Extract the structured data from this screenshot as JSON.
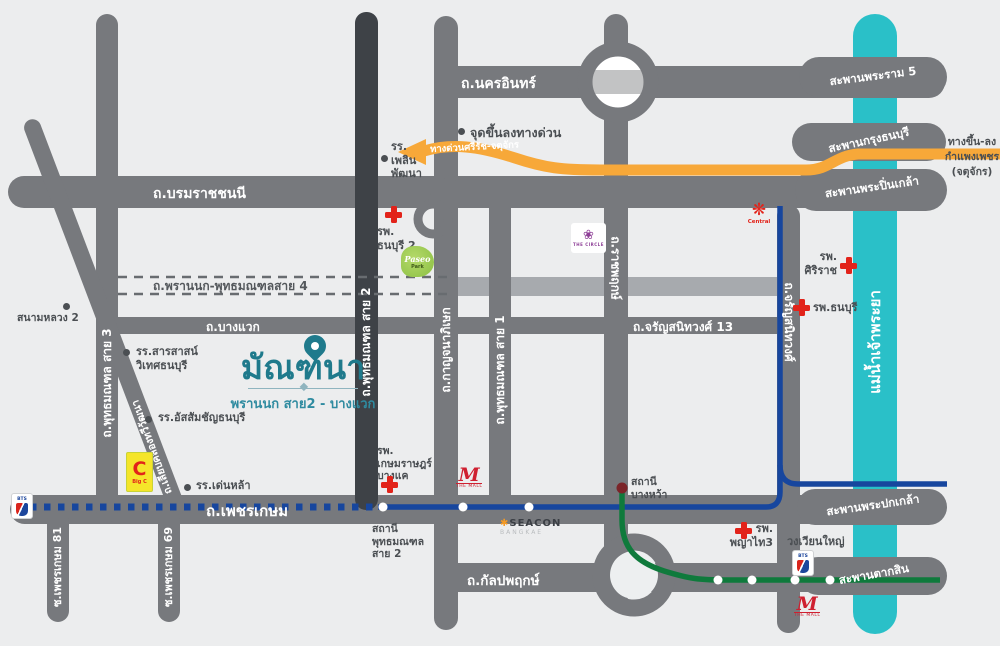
{
  "brand": {
    "name": "มัณฑนา",
    "subtitle": "พรานนก สาย2 - บางแวก"
  },
  "roads": {
    "nakhon_in": "ถ.นครอินทร์",
    "borommaratchachonnani": "ถ.บรมราชชนนี",
    "phran_nok_sai4": "ถ.พรานนก-พุทธมณฑลสาย 4",
    "bang_waek": "ถ.บางแวก",
    "charan_sanitwong_13": "ถ.จรัญสนิทวงศ์ 13",
    "phetkasem": "ถ.เพชรเกษม",
    "kanlapaphruek": "ถ.กัลปพฤกษ์",
    "phutthamonthon_sai3": "ถ.พุทธมณฑล สาย 3",
    "phutthamonthon_sai2": "ถ.พุทธมณฑล สาย 2",
    "kanchanaphisek": "ถ.กาญจนาภิเษก",
    "phutthamonthon_sai1": "ถ.พุทธมณฑล สาย 1",
    "ratchaphruek": "ถ.ราชพฤกษ์",
    "charan_sanitwong": "ถ.จรัญสนิทวงศ์",
    "liap_khlong_thawi_watthana": "ถ.เลียบคลองทวีวัฒนา",
    "soi_phetkasem_81": "ซ.เพชรเกษม 81",
    "soi_phetkasem_69": "ซ.เพชรเกษม 69"
  },
  "bridges": {
    "rama5": "สะพานพระราม 5",
    "krung_thonburi": "สะพานกรุงธนบุรี",
    "phra_pinklao": "สะพานพระปิ่นเกล้า",
    "phra_pokklao": "สะพานพระปกเกล้า",
    "taksin": "สะพานตากสิน"
  },
  "river": "แม่น้ำเจ้าพระยา",
  "expressway": {
    "name": "ทางด่วนศรีรัช-จตุจักร",
    "entry_exit_point": "จุดขึ้นลงทางด่วน",
    "ramp_line1": "ทางขึ้น-ลง",
    "ramp_line2": "กำแพงเพชร",
    "ramp_line3": "(จตุจักร)"
  },
  "stations": {
    "sai2_line1": "สถานี",
    "sai2_line2": "พุทธมณฑล",
    "sai2_line3": "สาย 2",
    "bang_wa_line1": "สถานี",
    "bang_wa_line2": "บางหว้า"
  },
  "places": {
    "sanam_luang2": "สนามหลวง 2",
    "plearn_line1": "รร.",
    "plearn_line2": "เพลิน",
    "plearn_line3": "พัฒนา",
    "thonburi2_line1": "รพ.",
    "thonburi2_line2": "ธนบุรี 2",
    "sarasas_line1": "รร.สารสาสน์",
    "sarasas_line2": "วิเทศธนบุรี",
    "assumption": "รร.อัสสัมชัญธนบุรี",
    "denla": "รร.เด่นหล้า",
    "siriraj_line1": "รพ.",
    "siriraj_line2": "ศิริราช",
    "thonburi": "รพ.ธนบุรี",
    "kasemrad_line1": "รพ.",
    "kasemrad_line2": "เกษมราษฎร์",
    "kasemrad_line3": "บางแค",
    "phayathai3_line1": "รพ.",
    "phayathai3_line2": "พญาไท3",
    "wongwian_yai": "วงเวียนใหญ่"
  },
  "logos": {
    "paseo": "Paseo",
    "paseo_sub": "Park",
    "the_circle_icon": "❀",
    "the_circle": "THE CIRCLE",
    "central_icon": "❋",
    "central": "Central",
    "big_c_letter": "C",
    "big_c": "Big C",
    "the_mall_m": "M",
    "the_mall": "THE MALL",
    "seacon": "SEACON",
    "seacon_sub": "BANGKAE",
    "bts": "BTS"
  },
  "colors": {
    "background": "#ecedee",
    "road_gray": "#77797d",
    "road_dark": "#3e4247",
    "light_band": "#a7aaae",
    "river_cyan": "#2ac0c8",
    "expressway_orange": "#f7a839",
    "mrt_blue": "#17469e",
    "bts_green": "#0f7a3c",
    "brand_teal": "#1f7a8c",
    "hospital_red": "#e2231a"
  }
}
